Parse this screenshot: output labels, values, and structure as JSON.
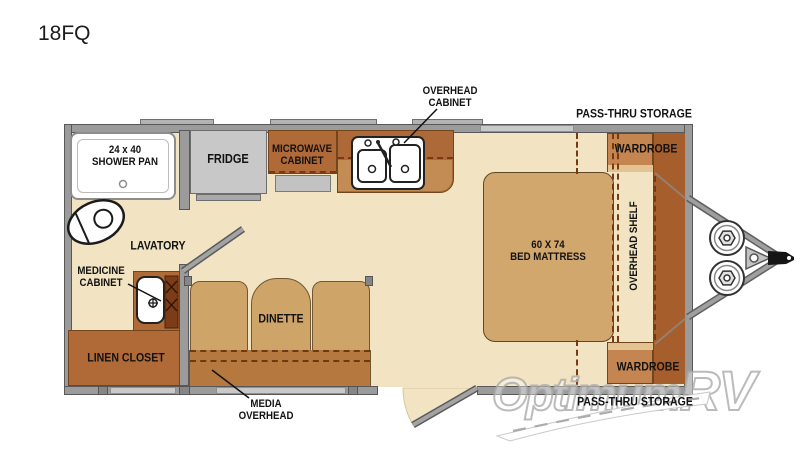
{
  "title": "18FQ",
  "watermark": {
    "part1": "Optimum",
    "part2": "RV"
  },
  "labels": {
    "shower_line1": "24 x 40",
    "shower_line2": "SHOWER PAN",
    "fridge": "FRIDGE",
    "microwave_line1": "MICROWAVE",
    "microwave_line2": "CABINET",
    "overhead_cabinet_line1": "OVERHEAD",
    "overhead_cabinet_line2": "CABINET",
    "pass_thru_top": "PASS-THRU STORAGE",
    "wardrobe_top": "WARDROBE",
    "lavatory": "LAVATORY",
    "medicine_line1": "MEDICINE",
    "medicine_line2": "CABINET",
    "linen_closet": "LINEN CLOSET",
    "dinette": "DINETTE",
    "media_line1": "MEDIA",
    "media_line2": "OVERHEAD",
    "bed_line1": "60 X 74",
    "bed_line2": "BED MATTRESS",
    "overhead_shelf": "OVERHEAD SHELF",
    "wardrobe_bottom": "WARDROBE",
    "pass_thru_bottom": "PASS-THRU STORAGE"
  },
  "colors": {
    "floor": "#f2e4c3",
    "cabinet_orange": "#b06a38",
    "counter_light": "#c48c55",
    "seat_tan": "#cfa468",
    "bed_tan": "#d2a76e",
    "media_overhead": "#b5793f",
    "wardrobe": "#c48550",
    "wardrobe_lip": "#e3c392",
    "front_column": "#a55e2c",
    "wall_gray": "#9b9b9b",
    "window_gray": "#c9c9c9",
    "fridge_gray": "#c8c8c8",
    "dash_brown": "#7a3714",
    "label_black": "#121212",
    "watermark_gray": "#a8a8a8"
  }
}
